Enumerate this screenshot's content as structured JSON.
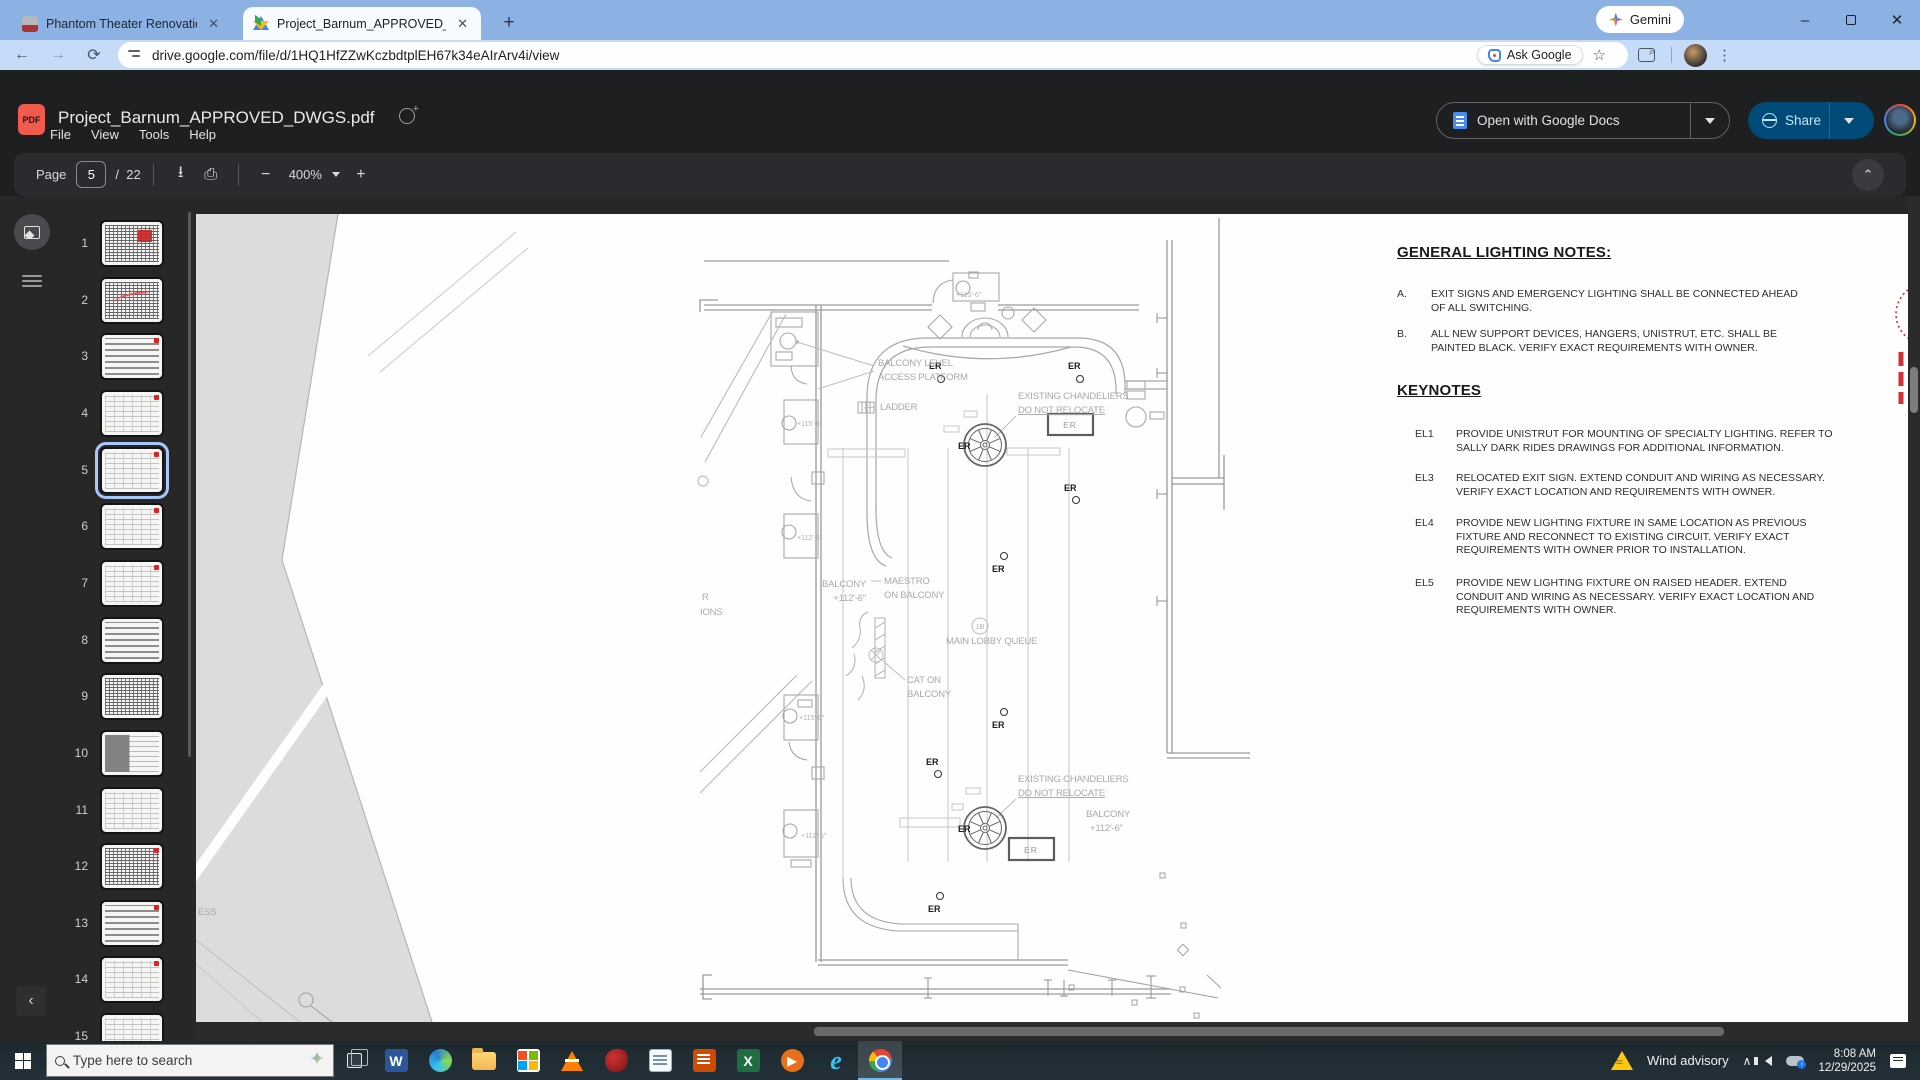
{
  "browser": {
    "tabs": [
      {
        "title": "Phantom Theater Renovation Pl",
        "close": "✕"
      },
      {
        "title": "Project_Barnum_APPROVED_DW",
        "close": "✕"
      }
    ],
    "new_tab": "+",
    "gemini_label": "Gemini",
    "url": "drive.google.com/file/d/1HQ1HfZZwKczbdtplEH67k34eAIrArv4i/view",
    "ask_google_label": "Ask Google",
    "bookmark_star": "☆",
    "back": "←",
    "forward": "→",
    "reload": "⟳",
    "minimize": "–",
    "close": "✕",
    "menu_dots": "⋮"
  },
  "pdf_viewer": {
    "title": "Project_Barnum_APPROVED_DWGS.pdf",
    "menu": {
      "file": "File",
      "view": "View",
      "tools": "Tools",
      "help": "Help"
    },
    "pdf_badge": "PDF",
    "toolbar": {
      "page_label": "Page",
      "current_page": "5",
      "page_separator": "/",
      "total_pages": "22",
      "zoom_out": "−",
      "zoom_level": "400%",
      "zoom_in": "+",
      "download_icon": "⭳",
      "print_icon": "⎙",
      "collapse_chevron": "⌃"
    },
    "open_with_label": "Open with Google Docs",
    "share_label": "Share"
  },
  "sidebar": {
    "collapse_chevron": "‹",
    "pages": [
      {
        "num": "1"
      },
      {
        "num": "2"
      },
      {
        "num": "3"
      },
      {
        "num": "4"
      },
      {
        "num": "5"
      },
      {
        "num": "6"
      },
      {
        "num": "7"
      },
      {
        "num": "8"
      },
      {
        "num": "9"
      },
      {
        "num": "10"
      },
      {
        "num": "11"
      },
      {
        "num": "12"
      },
      {
        "num": "13"
      },
      {
        "num": "14"
      },
      {
        "num": "15"
      }
    ],
    "selected_page": "5"
  },
  "document": {
    "notes": {
      "heading": "GENERAL LIGHTING NOTES:",
      "items": [
        {
          "label": "A.",
          "text": "EXIT SIGNS AND EMERGENCY LIGHTING SHALL BE CONNECTED AHEAD\nOF ALL SWITCHING."
        },
        {
          "label": "B.",
          "text": "ALL NEW SUPPORT DEVICES, HANGERS, UNISTRUT, ETC. SHALL BE\nPAINTED BLACK. VERIFY EXACT REQUIREMENTS WITH OWNER."
        }
      ]
    },
    "keynotes": {
      "heading": "KEYNOTES",
      "items": [
        {
          "code": "EL1",
          "text": "PROVIDE UNISTRUT FOR MOUNTING OF SPECIALTY LIGHTING. REFER TO\nSALLY DARK RIDES DRAWINGS FOR ADDITIONAL INFORMATION."
        },
        {
          "code": "EL3",
          "text": "RELOCATED EXIT SIGN. EXTEND CONDUIT AND WIRING AS NECESSARY.\nVERIFY EXACT LOCATION AND REQUIREMENTS WITH OWNER."
        },
        {
          "code": "EL4",
          "text": "PROVIDE NEW LIGHTING FIXTURE IN SAME LOCATION AS PREVIOUS\nFIXTURE AND RECONNECT TO EXISTING CIRCUIT. VERIFY EXACT\nREQUIREMENTS WITH OWNER PRIOR TO INSTALLATION."
        },
        {
          "code": "EL5",
          "text": "PROVIDE NEW LIGHTING FIXTURE ON RAISED HEADER. EXTEND\nCONDUIT AND WIRING AS NECESSARY. VERIFY EXACT LOCATION AND\nREQUIREMENTS WITH OWNER."
        }
      ]
    },
    "er_label": "ER",
    "drawing_labels": [
      "BALCONY LEVEL",
      "ACCESS PLATFORM",
      "LADDER",
      "EXISTING CHANDELIERS",
      "DO NOT RELOCATE",
      "MAESTRO",
      "ON BALCONY",
      "BALCONY",
      "+112'-6\"",
      "MAIN LOBBY QUEUE",
      "CAT ON",
      "BALCONY",
      "EXISTING CHANDELIERS",
      "DO NOT RELOCATE",
      "BALCONY",
      "+112'-6\"",
      "R",
      "IONS",
      "ESS",
      "+115'-6\"",
      "+115'-6\"",
      "+112'-6\"",
      "+115'-6\"",
      "+112'-6\"",
      "1B"
    ]
  },
  "taskbar": {
    "search_placeholder": "Type here to search",
    "copilot_sparkle": "✦",
    "icons": [
      "start",
      "task-view",
      "word",
      "edge",
      "file-explorer",
      "store",
      "vlc",
      "app-red",
      "notepad",
      "wordpad",
      "excel",
      "media-player",
      "internet-explorer",
      "chrome"
    ],
    "word_letter": "W",
    "excel_letter": "X",
    "ie_letter": "e",
    "player_glyph": "▶",
    "tray": {
      "alert": "Wind advisory",
      "hidden_icons_chevron": "∧",
      "time": "8:08 AM",
      "date": "12/29/2025"
    }
  }
}
